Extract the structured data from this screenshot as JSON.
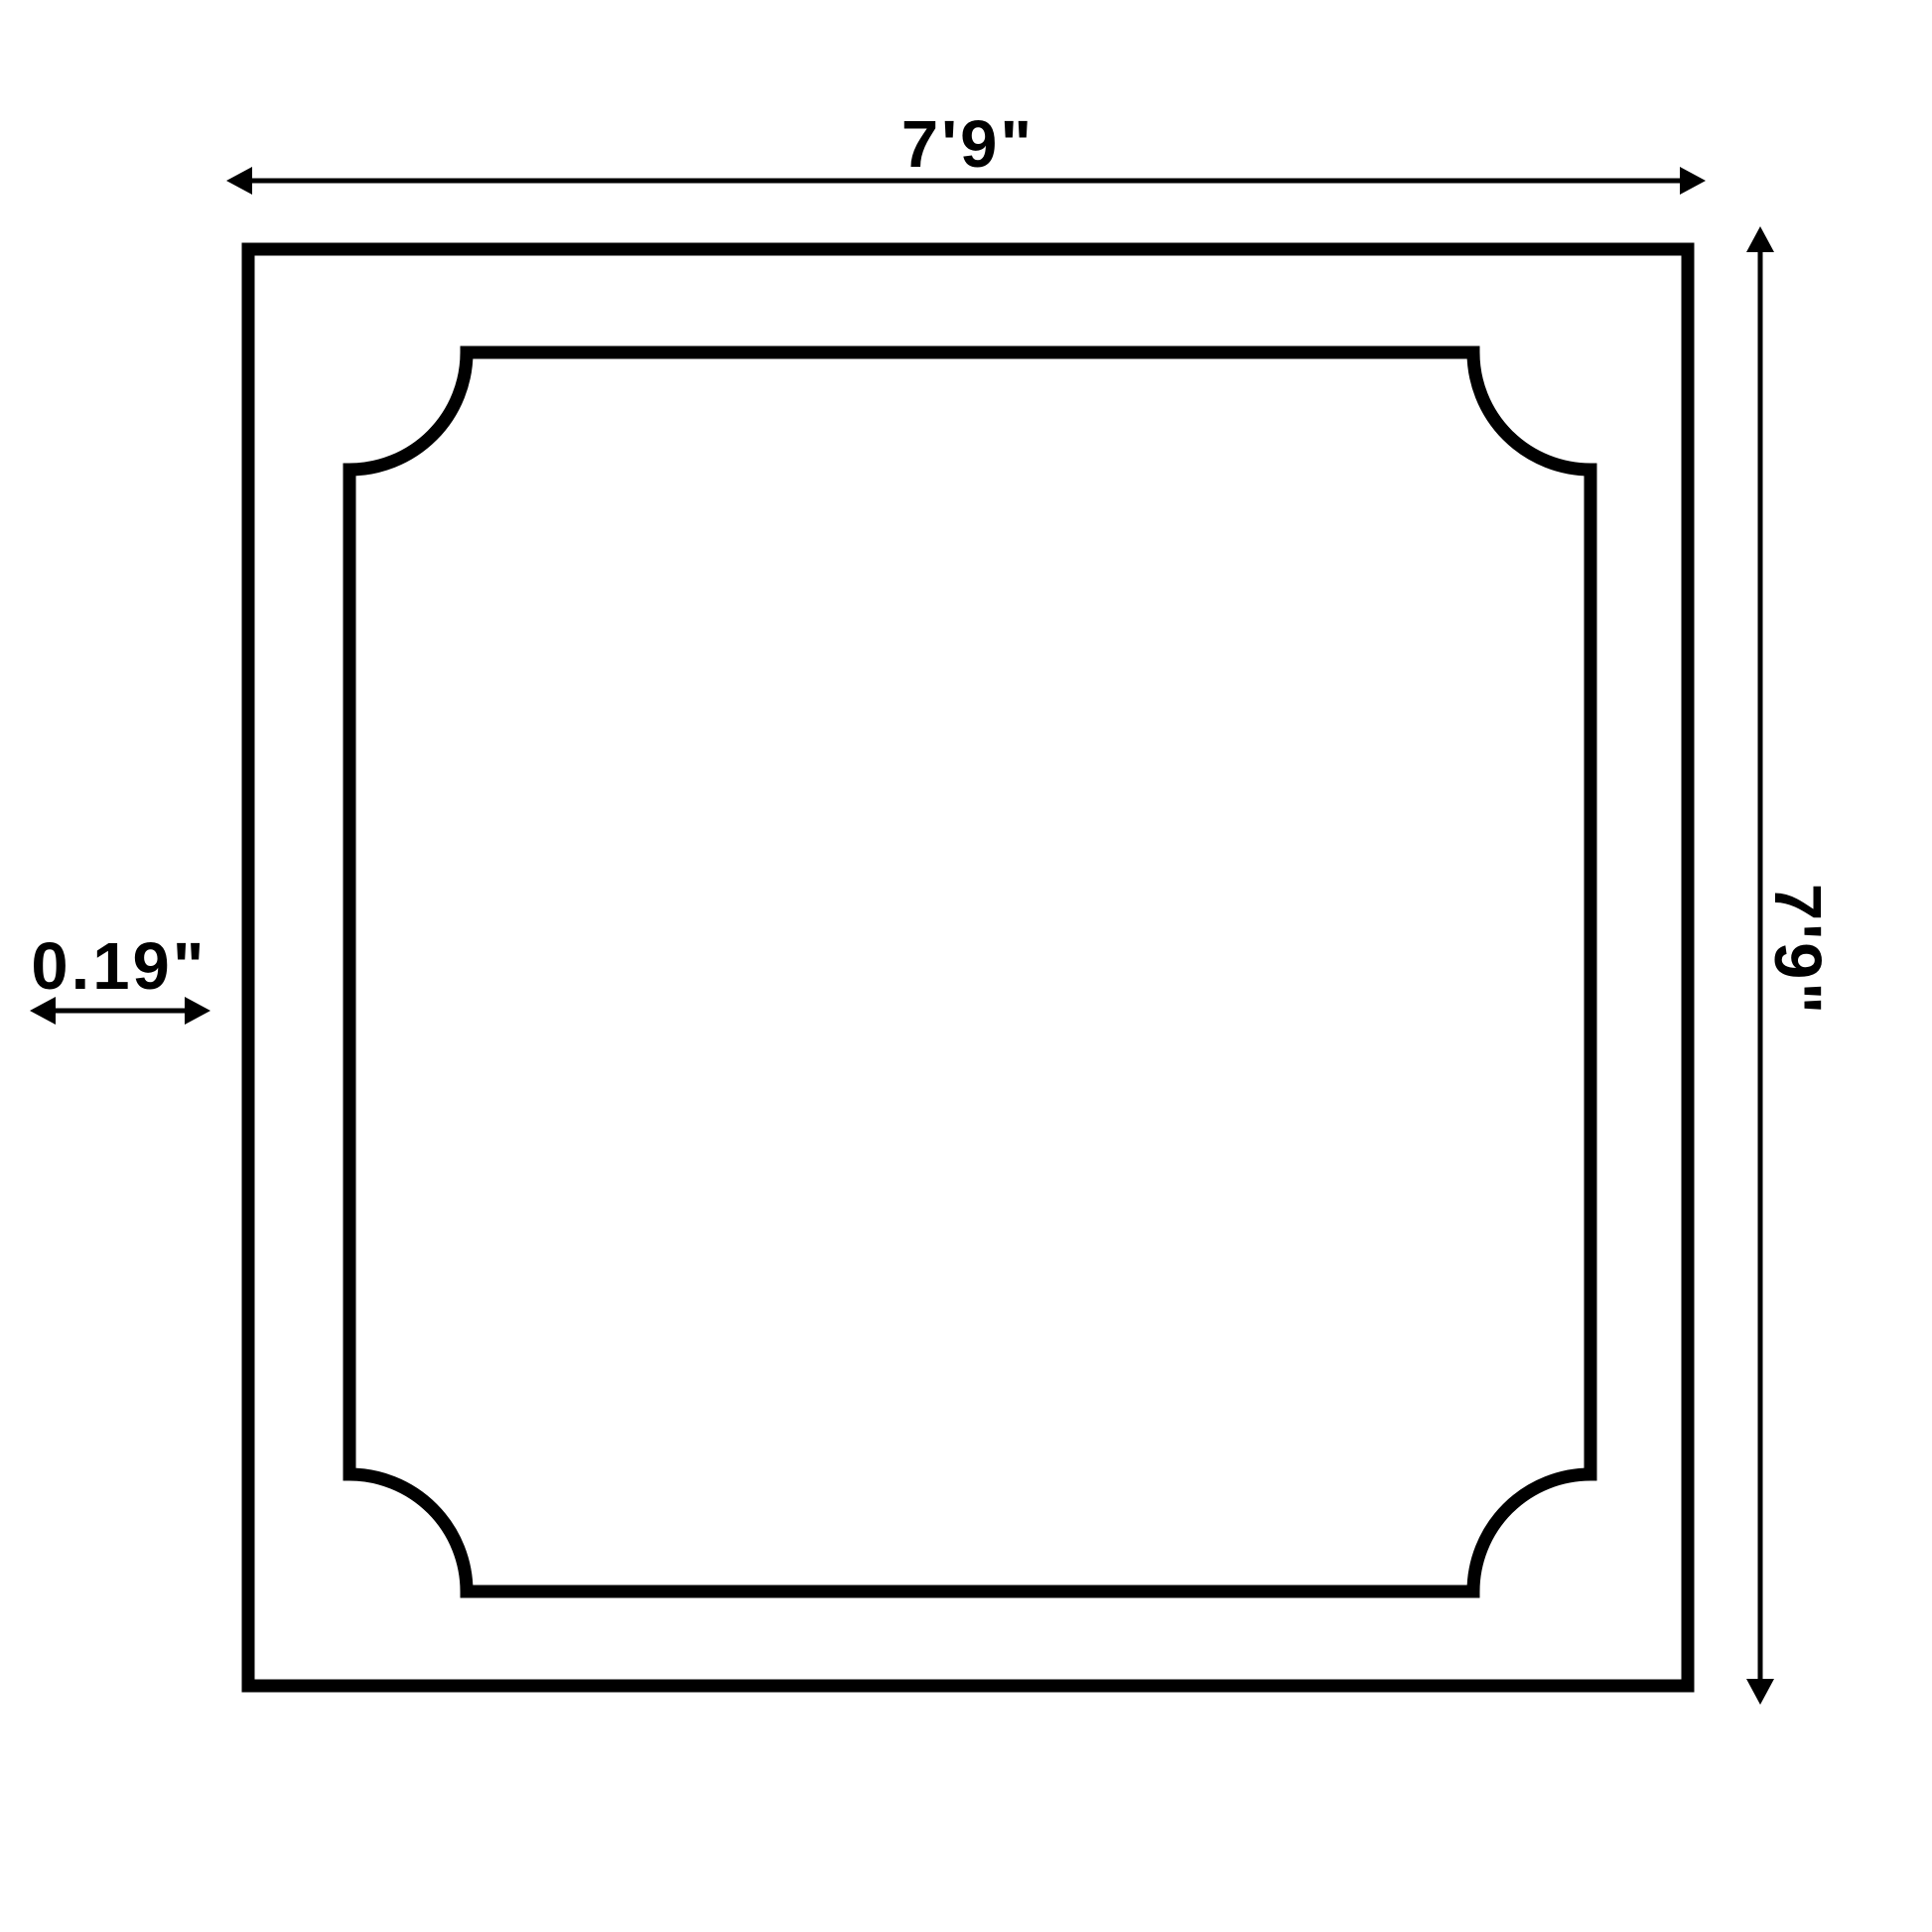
{
  "diagram": {
    "type": "panel-dimension-drawing",
    "line_color": "#000000",
    "background_color": "#ffffff",
    "dimensions": {
      "top_width_label": "7'9\"",
      "right_height_label": "7'9\"",
      "left_thickness_label": "0.19\""
    }
  }
}
